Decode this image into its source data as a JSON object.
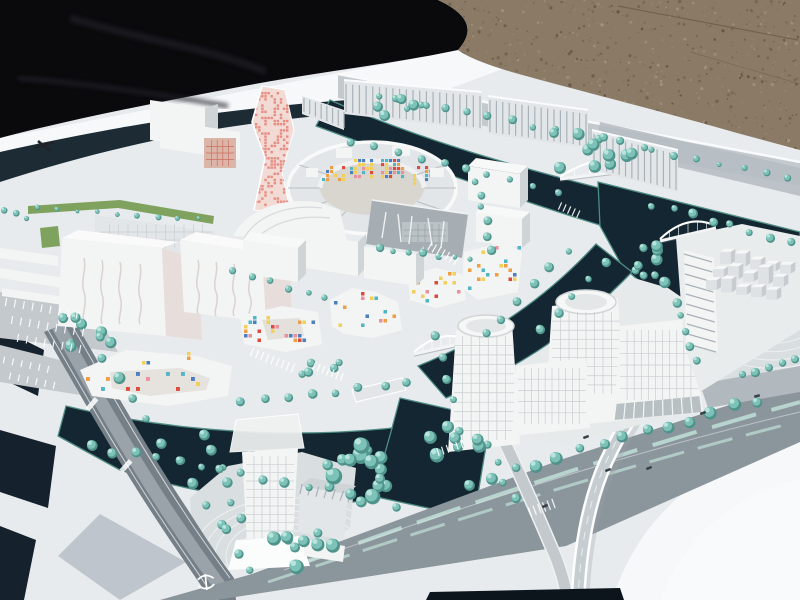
{
  "image": {
    "type": "photograph",
    "subject": "Architectural scale model of a waterfront urban district (white buildings, teal model trees, dark canal water) photographed outdoors at an angle, resting on gravel ground with black fabric beside it",
    "width": 800,
    "height": 600
  },
  "palette": {
    "fabric": "#0a0a0d",
    "fabric_fold": "#23242b",
    "gravel": "#8b7a66",
    "gravel_dark": "#6b5d4b",
    "gravel_mid": "#7d6e5a",
    "gravel_light": "#a5947d",
    "board": "#e8ebee",
    "board_bright": "#f6f8fa",
    "board_shadow": "#b7bec6",
    "swoosh": "#1c2b34",
    "navy": "#15222e",
    "navy_deep": "#0d151c",
    "water": "#132631",
    "water_fringe": "#4e8c84",
    "road": "#8b959c",
    "road_dark": "#757f87",
    "road_mid": "#99a3a9",
    "road_light": "#c3c9cd",
    "plaza": "#d9dee1",
    "plaza_line": "#f2f5f6",
    "bw": "#f3f4f4",
    "bf": "#e3e6e8",
    "bs": "#cfd4d7",
    "bside_pink": "#e7dddb",
    "bgray": "#a7aeb3",
    "grid_line": "#c9ced2",
    "rib_line": "#a9b2b8",
    "pink_tower": "#f2dad5",
    "pink_dot": "#e78d82",
    "red_facade": "#dcb5a9",
    "red_grid": "#cd6f60",
    "green": "#7fa35f",
    "median": "#b7d4ce",
    "tree": "#7cc2b8",
    "tree_dark": "#4f938a",
    "tree_light": "#b9e4dc",
    "mark_white": "#ffffff",
    "mark_dark": "#3c4148",
    "wave_line": "#dcd2cf",
    "streak": "#eef0f1"
  },
  "scene": {
    "notes": {
      "road_text": "tiny illegible white street-name markings painted on roads",
      "base_mark": "small dark illegible logo mark printed on white model base, upper left",
      "road_logo": "small white rail-transit style logo painted on dark road, bottom centre-left"
    },
    "mosaic_colors": [
      "#dd4a3e",
      "#ee9f45",
      "#f2cf56",
      "#4d7fc0",
      "#52b5c6",
      "#ea8f9d"
    ],
    "speckles": {
      "x": 440,
      "y": 0,
      "w": 358,
      "h": 150,
      "n": 850,
      "colors": [
        "#6b5d4b",
        "#7d6e5a",
        "#a5947d",
        "#5f5344",
        "#93826c"
      ]
    },
    "trees": {
      "rows": [
        [
          378,
          96,
          642,
          146,
          13,
          3.6
        ],
        [
          652,
          150,
          788,
          176,
          7,
          3.2
        ],
        [
          36,
          208,
          198,
          218,
          9,
          2.4
        ],
        [
          104,
          356,
          222,
          524,
          9,
          4.8
        ],
        [
          224,
          530,
          252,
          572,
          3,
          4.8
        ],
        [
          90,
          446,
          350,
          492,
          13,
          4.4
        ],
        [
          238,
          400,
          408,
          384,
          8,
          4.2
        ],
        [
          368,
          450,
          398,
          504,
          4,
          5.2
        ],
        [
          486,
          446,
          514,
          500,
          4,
          4.4
        ],
        [
          470,
          482,
          756,
          400,
          14,
          5.2
        ],
        [
          434,
          334,
          452,
          400,
          4,
          4
        ],
        [
          204,
          434,
          238,
          516,
          6,
          4.4
        ],
        [
          676,
          300,
          696,
          358,
          5,
          4
        ],
        [
          744,
          374,
          794,
          358,
          5,
          4.2
        ],
        [
          652,
          204,
          790,
          242,
          8,
          4.2
        ],
        [
          352,
          140,
          556,
          192,
          10,
          3.8
        ],
        [
          476,
          180,
          492,
          250,
          6,
          3.8
        ],
        [
          378,
          248,
          468,
          260,
          7,
          3.4
        ],
        [
          4,
          210,
          26,
          218,
          3,
          2.8
        ],
        [
          232,
          272,
          326,
          296,
          6,
          3.6
        ],
        [
          566,
          252,
          486,
          334,
          6,
          4
        ],
        [
          606,
          262,
          540,
          330,
          5,
          4
        ]
      ],
      "clusters": [
        [
          352,
          472,
          62,
          58,
          12,
          4.5,
          8.5
        ],
        [
          302,
          550,
          60,
          42,
          9,
          4,
          7.5
        ],
        [
          592,
          152,
          84,
          42,
          11,
          3.5,
          6.5
        ],
        [
          642,
          264,
          50,
          44,
          9,
          3.5,
          6.5
        ],
        [
          86,
          332,
          64,
          32,
          8,
          3.5,
          6.5
        ],
        [
          400,
          110,
          54,
          34,
          7,
          3,
          5.5
        ],
        [
          452,
          440,
          54,
          34,
          8,
          4,
          7.5
        ],
        [
          320,
          368,
          40,
          26,
          5,
          3,
          5
        ]
      ]
    },
    "mosaics": [
      {
        "x": 322,
        "y": 166,
        "w": 24,
        "h": 20,
        "t": 4,
        "p": 0.55,
        "tgt": "gCircle"
      },
      {
        "x": 350,
        "y": 159,
        "w": 27,
        "h": 21,
        "t": 4,
        "p": 0.55,
        "tgt": "gCircle"
      },
      {
        "x": 381,
        "y": 159,
        "w": 27,
        "h": 21,
        "t": 4,
        "p": 0.55,
        "tgt": "gCircle"
      },
      {
        "x": 413,
        "y": 166,
        "w": 24,
        "h": 20,
        "t": 4,
        "p": 0.55,
        "tgt": "gCircle"
      },
      {
        "x": 86,
        "y": 372,
        "w": 142,
        "h": 24,
        "t": 5,
        "p": 0.17,
        "tgt": "gMos"
      },
      {
        "x": 124,
        "y": 352,
        "w": 76,
        "h": 14,
        "t": 4.5,
        "p": 0.15,
        "tgt": "gMos"
      },
      {
        "x": 244,
        "y": 316,
        "w": 76,
        "h": 30,
        "t": 4.5,
        "p": 0.17,
        "tgt": "gMos"
      },
      {
        "x": 334,
        "y": 292,
        "w": 64,
        "h": 40,
        "t": 4.5,
        "p": 0.13,
        "tgt": "gMos"
      },
      {
        "x": 412,
        "y": 272,
        "w": 52,
        "h": 32,
        "t": 4.5,
        "p": 0.17,
        "tgt": "gMos"
      },
      {
        "x": 468,
        "y": 246,
        "w": 54,
        "h": 46,
        "t": 4.5,
        "p": 0.15,
        "tgt": "gMos"
      },
      {
        "x": 255,
        "y": 92,
        "w": 37,
        "h": 116,
        "t": 3.1,
        "p": 0.42,
        "color": "pink_dot",
        "tgt": "gPink"
      }
    ],
    "grids": [
      {
        "x": 100,
        "y": 224,
        "w": 112,
        "h": 24,
        "c": 12,
        "r": 3,
        "tgt": "gLB"
      },
      {
        "x": 246,
        "y": 456,
        "w": 48,
        "h": 100,
        "c": 6,
        "r": 12,
        "tgt": "gT1"
      },
      {
        "x": 454,
        "y": 336,
        "w": 60,
        "h": 104,
        "c": 7,
        "r": 11,
        "tgt": "gT2"
      },
      {
        "x": 552,
        "y": 312,
        "w": 68,
        "h": 82,
        "c": 8,
        "r": 9,
        "tgt": "gT3"
      },
      {
        "x": 518,
        "y": 368,
        "w": 68,
        "h": 56,
        "c": 10,
        "r": 5,
        "tgt": "gS1"
      },
      {
        "x": 620,
        "y": 330,
        "w": 78,
        "h": 70,
        "c": 11,
        "r": 6,
        "tgt": "gS2"
      },
      {
        "x": 206,
        "y": 140,
        "w": 28,
        "h": 26,
        "c": 5,
        "r": 4,
        "color": "#cd6f60",
        "tgt": "gRed"
      },
      {
        "x": 404,
        "y": 224,
        "w": 42,
        "h": 18,
        "c": 6,
        "r": 3,
        "color": "#96a0a6",
        "tgt": "gSlabC"
      }
    ],
    "ribs": [
      {
        "p": [
          346,
          84,
          480,
          96,
          480,
          128,
          346,
          112
        ],
        "n": 20,
        "tgt": "gNB"
      },
      {
        "p": [
          490,
          100,
          586,
          114,
          586,
          146,
          490,
          132
        ],
        "n": 15,
        "tgt": "gNB"
      },
      {
        "p": [
          594,
          134,
          676,
          154,
          676,
          190,
          594,
          168
        ],
        "n": 13,
        "tgt": "gNB"
      },
      {
        "p": [
          304,
          98,
          344,
          112,
          344,
          128,
          304,
          112
        ],
        "n": 7,
        "tgt": "gNB"
      },
      {
        "p": [
          684,
          254,
          688,
          344,
          716,
          352,
          712,
          262
        ],
        "n": 9,
        "tgt": "gSlabR"
      },
      {
        "p": [
          302,
          484,
          352,
          492,
          348,
          502,
          300,
          494
        ],
        "n": 6,
        "tgt": "gAnnex"
      },
      {
        "p": [
          616,
          404,
          700,
          396,
          702,
          412,
          614,
          420
        ],
        "n": 9,
        "color": "#f4f6f6",
        "tgt": "gS2"
      }
    ],
    "stripe_sets": [
      {
        "x": 252,
        "y": 352,
        "n": 9,
        "step": 5.5,
        "a": 22,
        "len": 9
      },
      {
        "x": 314,
        "y": 366,
        "n": 7,
        "step": 5,
        "a": 22,
        "len": 8
      },
      {
        "x": 430,
        "y": 246,
        "n": 7,
        "step": 5,
        "a": 30,
        "len": 9
      },
      {
        "x": 560,
        "y": 206,
        "n": 5,
        "step": 5,
        "a": 24,
        "len": 8
      },
      {
        "x": 438,
        "y": 452,
        "n": 6,
        "step": 5,
        "a": -18,
        "len": 8
      },
      {
        "x": 530,
        "y": 512,
        "n": 6,
        "step": 5,
        "a": -20,
        "len": 10
      },
      {
        "x": 6,
        "y": 302,
        "n": 9,
        "step": 9,
        "a": 10,
        "len": 8
      },
      {
        "x": 12,
        "y": 320,
        "n": 9,
        "step": 9,
        "a": 10,
        "len": 8
      },
      {
        "x": 18,
        "y": 338,
        "n": 8,
        "step": 9,
        "a": 10,
        "len": 8
      },
      {
        "x": 4,
        "y": 360,
        "n": 6,
        "step": 9,
        "a": 12,
        "len": 7
      },
      {
        "x": 10,
        "y": 376,
        "n": 6,
        "step": 9,
        "a": 12,
        "len": 7
      }
    ],
    "arcs": [
      {
        "cx": 290,
        "cy": 556,
        "n": 8,
        "r0": 20,
        "dr": 11,
        "ky": 0.6,
        "tgt": "gArcT1"
      },
      {
        "cx": 772,
        "cy": 300,
        "n": 6,
        "r0": 36,
        "dr": 11,
        "ky": 0.75,
        "tgt": "gArcR"
      }
    ],
    "cubes": {
      "x": 720,
      "y": 264,
      "cols": 5,
      "rows": 3,
      "cw": 15,
      "hmin": 7,
      "hmax": 17
    },
    "bridges": [
      {
        "x1": 560,
        "y1": 179,
        "x2": 648,
        "y2": 168,
        "rise": 13
      },
      {
        "x1": 660,
        "y1": 241,
        "x2": 716,
        "y2": 228,
        "rise": 11
      },
      {
        "x1": 414,
        "y1": 354,
        "x2": 468,
        "y2": 342,
        "rise": 10
      }
    ],
    "cars": [
      [
        586,
        437,
        -20
      ],
      [
        649,
        468,
        -20
      ],
      [
        703,
        413,
        -18
      ],
      [
        545,
        506,
        -22
      ],
      [
        757,
        396,
        -16
      ],
      [
        608,
        470,
        -20
      ]
    ],
    "smudges": [
      [
        92,
        404,
        5,
        14,
        40
      ],
      [
        126,
        466,
        5,
        14,
        42
      ]
    ]
  }
}
